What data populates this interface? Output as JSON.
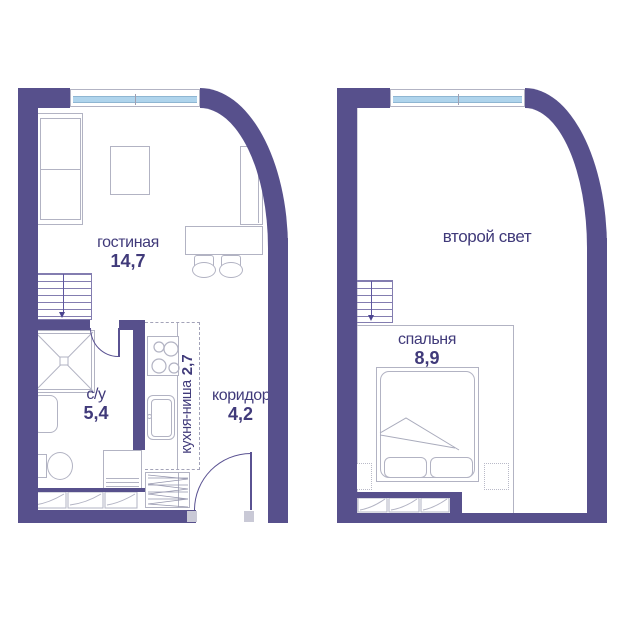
{
  "plan_type": "two-level apartment floor plan",
  "rooms": {
    "living": {
      "label": "гостиная",
      "area": "14,7"
    },
    "bathroom": {
      "label": "с/у",
      "area": "5,4"
    },
    "kitchen": {
      "label": "кухня-ниша",
      "area": "2,7"
    },
    "corridor": {
      "label": "коридор",
      "area": "4,2"
    },
    "second_light": {
      "label": "второй свет"
    },
    "bedroom": {
      "label": "спальня",
      "area": "8,9"
    }
  },
  "colors": {
    "wall": "#57508C",
    "window_glass": "#AFD4EC",
    "furniture_line": "#B2B3C3",
    "text": "#403A7A"
  }
}
